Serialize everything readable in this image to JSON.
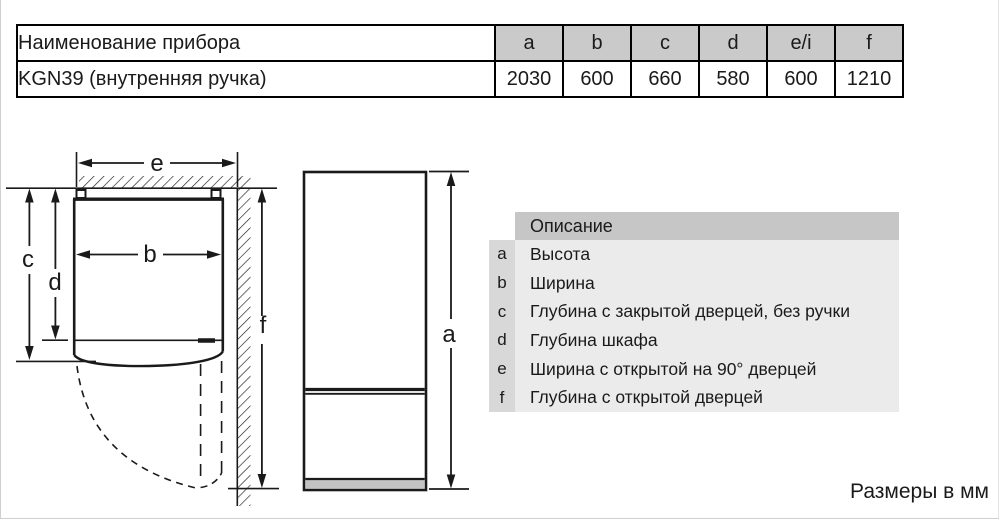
{
  "table": {
    "name_header": "Наименование прибора",
    "model": "KGN39 (внутренняя ручка)",
    "dims": [
      {
        "key": "a",
        "value": "2030"
      },
      {
        "key": "b",
        "value": "600"
      },
      {
        "key": "c",
        "value": "660"
      },
      {
        "key": "d",
        "value": "580"
      },
      {
        "key": "e/i",
        "value": "600"
      },
      {
        "key": "f",
        "value": "1210"
      }
    ]
  },
  "legend": {
    "title": "Описание",
    "items": [
      {
        "key": "a",
        "label": "Высота"
      },
      {
        "key": "b",
        "label": "Ширина"
      },
      {
        "key": "c",
        "label": "Глубина с закрытой дверцей, без ручки"
      },
      {
        "key": "d",
        "label": "Глубина шкафа"
      },
      {
        "key": "e",
        "label": "Ширина с открытой на 90° дверцей"
      },
      {
        "key": "f",
        "label": "Глубина с открытой дверцей"
      }
    ]
  },
  "diagram": {
    "top_view_labels": {
      "e": "e",
      "b": "b",
      "c": "c",
      "d": "d",
      "f": "f"
    },
    "front_view_labels": {
      "a": "a"
    }
  },
  "footer": {
    "units_note": "Размеры в мм"
  },
  "colors": {
    "table_header_bg": "#cacaca",
    "legend_title_bg": "#c6c6c6",
    "legend_key_bg": "#d8d8d8",
    "legend_body_bg": "#ebebeb",
    "plinth_gray": "#c3c3c3",
    "line_black": "#1a1a1a"
  }
}
